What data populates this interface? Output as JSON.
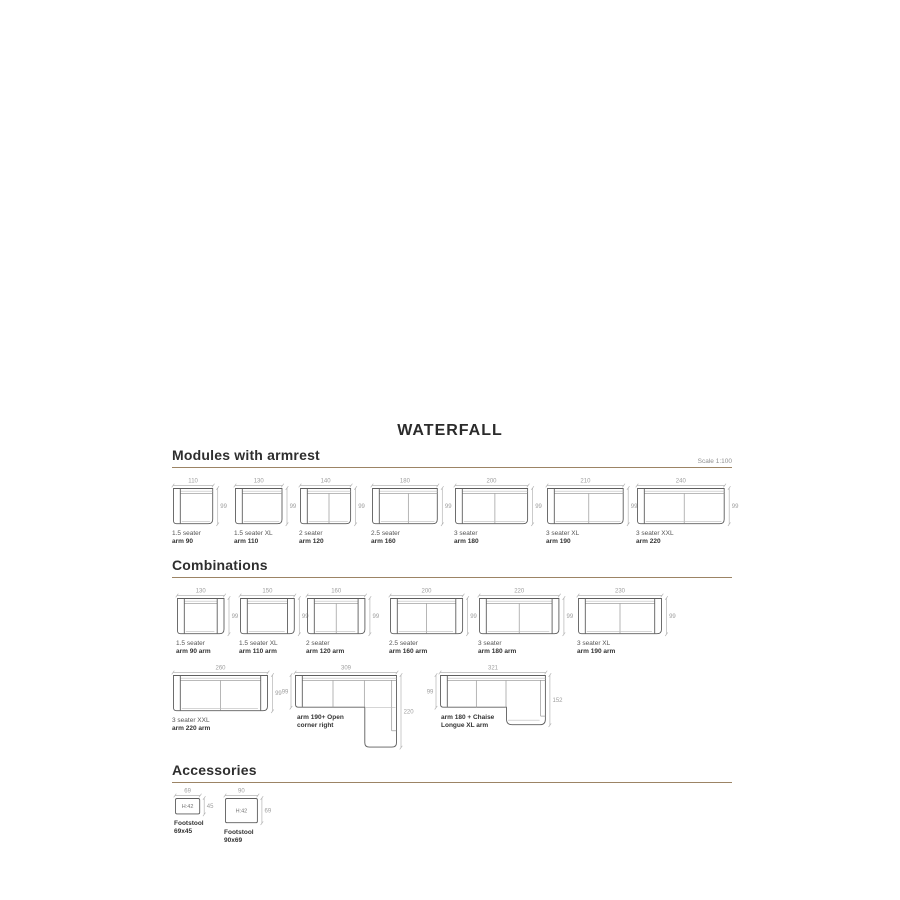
{
  "page": {
    "title": "WATERFALL",
    "scale_note": "Scale 1:100"
  },
  "colors": {
    "rule": "#9c8465",
    "heading": "#2e2e2e",
    "drawing_outline": "#5e5e5e",
    "drawing_inner_line": "#8f8f8f",
    "dimension": "#9e9e9e",
    "label": "#565656",
    "label_bold": "#333333"
  },
  "sections": {
    "modules": {
      "heading": "Modules with armrest",
      "items": [
        {
          "kind": "module",
          "name": "1.5 seater",
          "size": "arm 90",
          "width_cm": 110,
          "depth_cm": 99,
          "arms": "left",
          "seams": 0
        },
        {
          "kind": "module",
          "name": "1.5 seater XL",
          "size": "arm 110",
          "width_cm": 130,
          "depth_cm": 99,
          "arms": "left",
          "seams": 0
        },
        {
          "kind": "module",
          "name": "2 seater",
          "size": "arm 120",
          "width_cm": 140,
          "depth_cm": 99,
          "arms": "left",
          "seams": 1
        },
        {
          "kind": "module",
          "name": "2.5 seater",
          "size": "arm 160",
          "width_cm": 180,
          "depth_cm": 99,
          "arms": "left",
          "seams": 1
        },
        {
          "kind": "module",
          "name": "3 seater",
          "size": "arm 180",
          "width_cm": 200,
          "depth_cm": 99,
          "arms": "left",
          "seams": 1
        },
        {
          "kind": "module",
          "name": "3 seater XL",
          "size": "arm 190",
          "width_cm": 210,
          "depth_cm": 99,
          "arms": "left",
          "seams": 1
        },
        {
          "kind": "module",
          "name": "3 seater XXL",
          "size": "arm 220",
          "width_cm": 240,
          "depth_cm": 99,
          "arms": "left",
          "seams": 1
        }
      ]
    },
    "combinations": {
      "heading": "Combinations",
      "row1": [
        {
          "kind": "module",
          "name": "1.5 seater",
          "size": "arm 90 arm",
          "width_cm": 130,
          "depth_cm": 99,
          "arms": "both",
          "seams": 0
        },
        {
          "kind": "module",
          "name": "1.5 seater XL",
          "size": "arm 110 arm",
          "width_cm": 150,
          "depth_cm": 99,
          "arms": "both",
          "seams": 0
        },
        {
          "kind": "module",
          "name": "2 seater",
          "size": "arm 120 arm",
          "width_cm": 160,
          "depth_cm": 99,
          "arms": "both",
          "seams": 1
        },
        {
          "kind": "module",
          "name": "2.5 seater",
          "size": "arm 160 arm",
          "width_cm": 200,
          "depth_cm": 99,
          "arms": "both",
          "seams": 1
        },
        {
          "kind": "module",
          "name": "3 seater",
          "size": "arm 180 arm",
          "width_cm": 220,
          "depth_cm": 99,
          "arms": "both",
          "seams": 1
        },
        {
          "kind": "module",
          "name": "3 seater XL",
          "size": "arm 190 arm",
          "width_cm": 230,
          "depth_cm": 99,
          "arms": "both",
          "seams": 1
        }
      ],
      "row2": [
        {
          "kind": "module",
          "name": "3 seater XXL",
          "size": "arm 220 arm",
          "width_cm": 260,
          "depth_cm": 99,
          "arms": "both",
          "seams": 1
        },
        {
          "kind": "corner",
          "label_line1": "arm 190+ Open",
          "label_line2": "corner right",
          "width_cm": 309,
          "depth_cm": 99,
          "ext_depth_cm": 220,
          "ext_width_cm": 99,
          "seam_cms": [
            115,
            210
          ]
        },
        {
          "kind": "chaise",
          "label_line1": "arm 180 + Chaise",
          "label_line2": "Longue XL arm",
          "width_cm": 321,
          "depth_cm": 99,
          "ext_depth_cm": 152,
          "ext_width_cm": 121,
          "seam_cms": [
            110,
            200
          ]
        }
      ]
    },
    "accessories": {
      "heading": "Accessories",
      "items": [
        {
          "kind": "footstool",
          "name": "Footstool",
          "size": "69x45",
          "width_cm": 69,
          "depth_cm": 45,
          "height_label": "H:42"
        },
        {
          "kind": "footstool",
          "name": "Footstool",
          "size": "90x69",
          "width_cm": 90,
          "depth_cm": 69,
          "height_label": "H:42"
        }
      ]
    }
  }
}
